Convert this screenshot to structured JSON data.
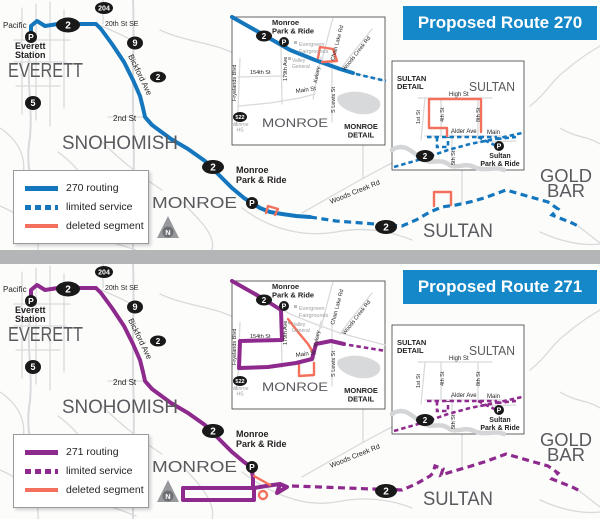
{
  "colors": {
    "c270": "#1476bd",
    "c271": "#8e2a8d",
    "deleted": "#f3715c",
    "header": "#1588c9",
    "header_text": "#ffffff",
    "divider": "#b3b5b7",
    "city": "#595a5e",
    "road": "#d9dadb",
    "shield": "#191919",
    "map_bg": "#fcfcfb",
    "small_label": "#231f20",
    "muted_label": "#9b9da0"
  },
  "panel270": {
    "title": "Proposed Route 270",
    "legend_routing": "270 routing",
    "legend_limited": "limited service",
    "legend_deleted": "deleted segment"
  },
  "panel271": {
    "title": "Proposed Route 271",
    "legend_routing": "271 routing",
    "legend_limited": "limited service",
    "legend_deleted": "deleted segment"
  },
  "labels": {
    "pacific": "Pacific",
    "everett_station_1": "Everett",
    "everett_station_2": "Station",
    "everett": "EVERETT",
    "snohomish": "SNOHOMISH",
    "monroe": "MONROE",
    "sultan": "SULTAN",
    "gold": "GOLD",
    "bar": "BAR",
    "st_20th": "20th St SE",
    "bickford": "Bickford Ave",
    "st_2nd": "2nd St",
    "woods_creek": "Woods Creek Rd",
    "monroe_pr_1": "Monroe",
    "monroe_pr_2": "Park & Ride",
    "sultan_pr_1": "Sultan",
    "sultan_pr_2": "Park & Ride",
    "monroe_detail_1": "MONROE",
    "monroe_detail_2": "DETAIL",
    "sultan_detail_1": "SULTAN",
    "sultan_detail_2": "DETAIL",
    "evergreen_1": "Evergreen",
    "evergreen_2": "Fairgrounds",
    "valley_1": "Valley",
    "valley_2": "General",
    "monroe_hs_1": "Monroe",
    "monroe_hs_2": "HS",
    "chain_lake": "Chain Lake Rd",
    "st_154th": "154th St",
    "ave_179th": "179th Ave",
    "fryelands": "Fryelands Blvd",
    "kelsey": "Kelsey",
    "main_st": "Main St",
    "s_lewis": "S Lewis St",
    "high_st": "High St",
    "st_1st": "1st St",
    "st_4th": "4th St",
    "st_8th": "8th St",
    "st_5th": "5th St",
    "alder": "Alder Ave",
    "main": "Main"
  },
  "shields": {
    "us2": "2",
    "sr204": "204",
    "sr9": "9",
    "i5": "5",
    "sr522": "522"
  },
  "icons": {
    "park_and_ride": "P",
    "north": "N"
  }
}
